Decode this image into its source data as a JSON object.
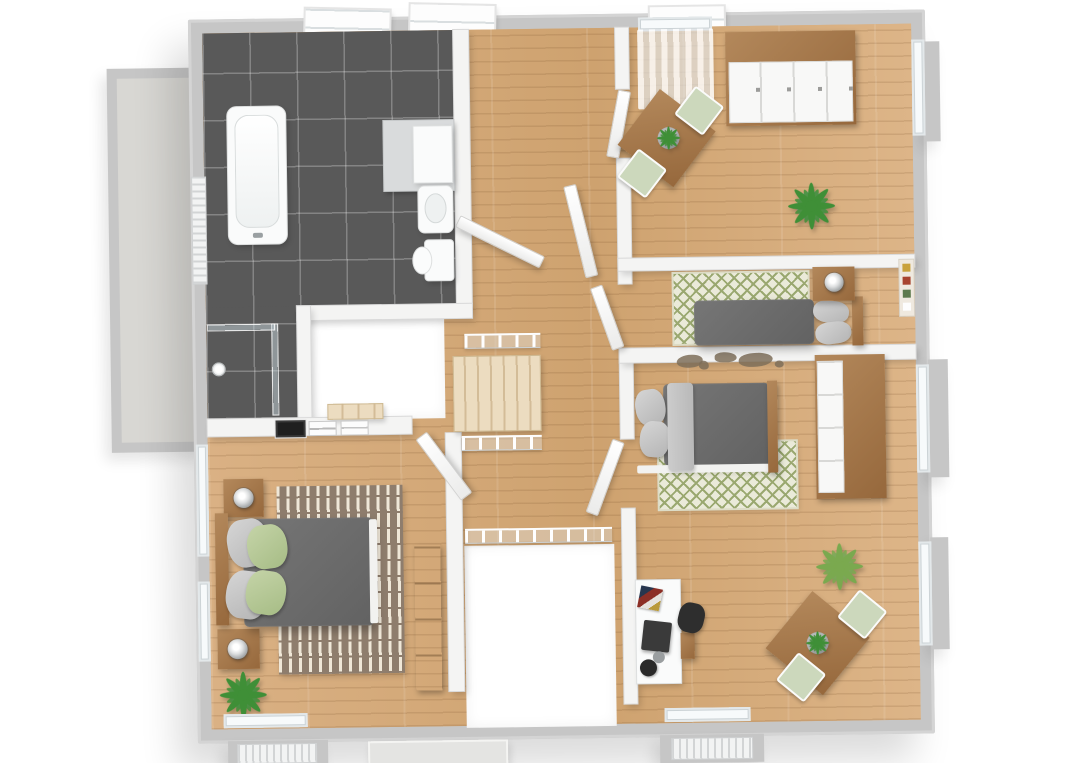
{
  "scene": {
    "kind": "3d-floor-plan-render",
    "view": "top-down isometric",
    "storey": "upper floor with stair voids",
    "background": "#ffffff"
  },
  "palette": {
    "wall_exterior": "#c6c6c6",
    "wall_interior": "#f4f4f3",
    "wood_floor": "#d7ae80",
    "tile_floor": "#595959",
    "balcony_floor": "#d8d7d3",
    "stair_tread": "#ecdcc0",
    "furniture_wood": "#96683c",
    "duvet_gray": "#626262",
    "pillow_gray": "#b4b4b4",
    "pillow_green": "#a6bc85",
    "rug_green_base": "#eaead9",
    "rug_green_pattern": "#9aa870",
    "rug_brown_base": "#8e7d6d",
    "rug_brown_dash": "#efe7d8",
    "plant_green": "#3f8f37",
    "plant_green_light": "#7aa94f",
    "chair_green": "#ccd8bc",
    "white_fixture": "#fafbfb",
    "monitor_dark": "#3a3a3a",
    "desk_chair_dark": "#2e2e2e",
    "lamp_silver": "#9fa3a5",
    "map_brown": "#7e6e59"
  },
  "rooms": [
    {
      "id": "bathroom",
      "label": "bathroom",
      "floor": "dark-gray-tile",
      "contents": [
        "bathtub",
        "corner-shower",
        "vanity-counter-with-basin",
        "toilet",
        "towel-radiator",
        "two-roof-windows"
      ]
    },
    {
      "id": "hallway",
      "label": "hallway-landing",
      "floor": "wood",
      "contents": [
        "staircase-down",
        "stair-void",
        "second-void",
        "white-railings",
        "open-doors"
      ]
    },
    {
      "id": "study",
      "label": "top-right-room",
      "floor": "wood",
      "contents": [
        "wardrobe-white-wood",
        "square-table-two-green-chairs",
        "table-plant",
        "floor-plant",
        "curtained-window"
      ]
    },
    {
      "id": "bedroom-small",
      "label": "right-middle-bedroom",
      "floor": "wood",
      "contents": [
        "double-bed-gray",
        "nightstand-with-round-lamp",
        "ogee-pattern-rug",
        "wall-pictures"
      ]
    },
    {
      "id": "bedroom-office",
      "label": "bottom-right-bedroom",
      "floor": "wood",
      "contents": [
        "double-bed-gray",
        "ogee-pattern-rug",
        "wardrobe",
        "white-desk-with-monitor",
        "desk-chair",
        "square-table-two-green-chairs",
        "floor-plant",
        "world-map-wall-decal",
        "window-with-radiator"
      ]
    },
    {
      "id": "bedroom-master",
      "label": "bottom-left-master-bedroom",
      "floor": "wood",
      "contents": [
        "double-bed-gray-green-pillows",
        "two-nightstands-with-lamps",
        "striped-brown-rug",
        "wardrobe",
        "floor-plant",
        "three-wall-pictures",
        "window-with-radiator"
      ]
    },
    {
      "id": "balcony",
      "label": "left-balcony-terrace",
      "floor": "light-concrete",
      "contents": []
    }
  ]
}
